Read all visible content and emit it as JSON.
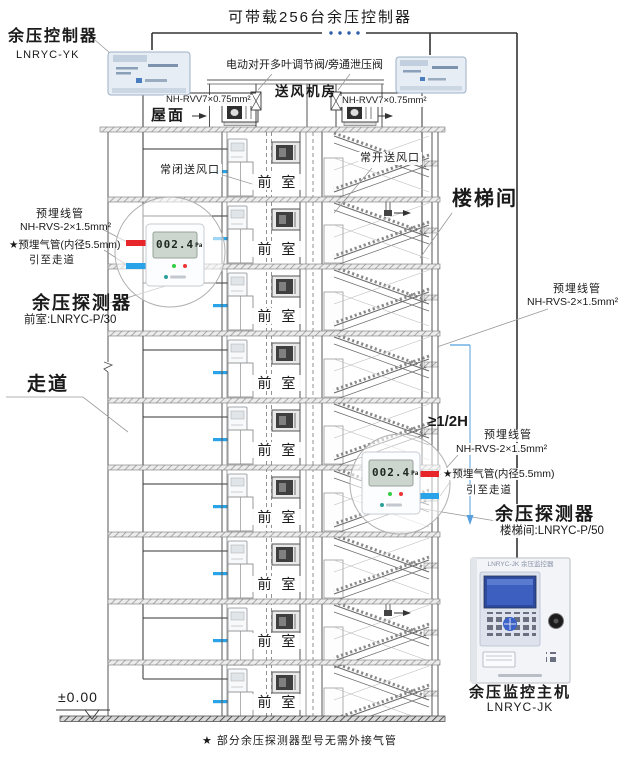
{
  "title": "可带载256台余压控制器",
  "controller": {
    "name": "余压控制器",
    "model": "LNRYC-YK"
  },
  "roof": {
    "surface": "屋面",
    "fan_room": "送风机房",
    "valve_label": "电动对开多叶调节阀/旁通泄压阀",
    "cable_left": "NH-RVV7×0.75mm²",
    "cable_right": "NH-RVV7×0.75mm²"
  },
  "vents": {
    "normally_closed": "常闭送风口",
    "normally_open": "常开送风口"
  },
  "rooms": {
    "stairwell": "楼梯间",
    "corridor": "走道"
  },
  "floors": {
    "front_room": "前 室"
  },
  "conduits": {
    "wire_title": "预埋线管",
    "wire_spec": "NH-RVS-2×1.5mm²",
    "air_line1": "★预埋气管(内径5.5mm)",
    "air_line2": "引至走道"
  },
  "detector_left": {
    "name": "余压探测器",
    "model": "前室:LNRYC-P/30",
    "lcd_value": "002.4",
    "lcd_unit": "Pa"
  },
  "detector_right": {
    "name": "余压探测器",
    "model": "楼梯间:LNRYC-P/50",
    "lcd_value": "002.4",
    "lcd_unit": "Pa"
  },
  "dimension": {
    "label": "≥1/2H"
  },
  "host": {
    "name": "余压监控主机",
    "model": "LNRYC-JK",
    "panel_title": "LNRYC-JK 余压监控器"
  },
  "level": {
    "label": "±0.00"
  },
  "footnote": "★ 部分余压探测器型号无需外接气管",
  "colors": {
    "wire_red": "#e8262a",
    "tube_blue": "#2aa3e8",
    "dim_blue": "#55a0dd",
    "line": "#4a4a4a"
  }
}
